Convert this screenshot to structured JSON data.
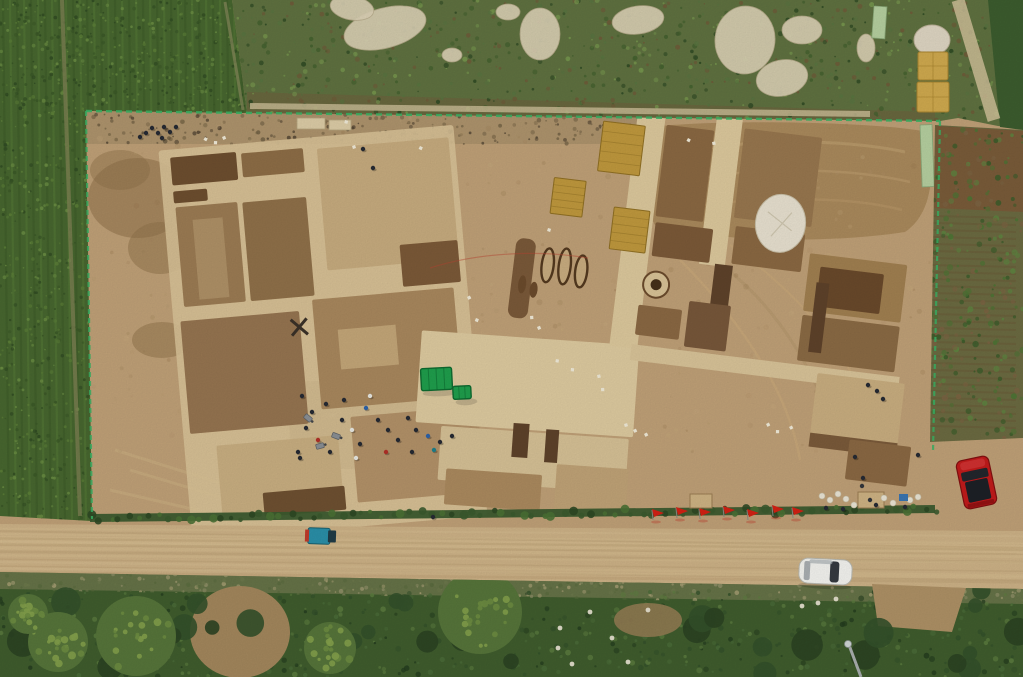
{
  "meta": {
    "type": "aerial-photograph",
    "description": "Aerial drone view of a large rectangular archaeological excavation compound cut into tan earth, surrounded by green corn fields and scrub. Gridded excavation trenches with light baulks fill the left half; the right half has corridors, yellow straw mats, dark grave pits, a round kiln feature and spoil heaps. A green canopy tent stands mid-site with a crew of workers nearby. A row of red flags lines the southern hedge beside a dirt road carrying a white car and a blue cargo trike, with a red car parked on dirt at the right and stacked hay bales at the top-right corner.",
    "width": 1023,
    "height": 677
  },
  "palette": {
    "base_dirt": "#bfa077",
    "dirt_light": "#d2b98d",
    "dirt_dark": "#a1835b",
    "baulk": "#d8c297",
    "platform": "#ddca9f",
    "cell_brown": "#9b7b53",
    "cell_dark": "#7b5938",
    "pit_deep": "#5e422a",
    "corn": "#47662f",
    "scrub": "#5f7140",
    "garden": "#6b6a41",
    "veg_dark": "#3f5c2d",
    "tree_dark": "#2b4222",
    "tree_yellow": "#83a04b",
    "road": "#ccb186",
    "hedge": "#3b5a2e",
    "fence_green": "#3bb264",
    "tent_green": "#1f9e4c",
    "straw": "#bf983d",
    "hay": "#cfa94e",
    "flag_red": "#d22114",
    "car_red": "#c11b1b",
    "car_white": "#f3f3ef",
    "trike_blue": "#2a8fa8",
    "debris": "#dbd1b5",
    "tarp_white": "#e7e0cf"
  },
  "scene": {
    "noise_seed": 7,
    "corn": {
      "row_step": 7,
      "row_colors": [
        "#3d5a29",
        "#567a38"
      ]
    },
    "speckle_layers": [
      {
        "clip": "compound-speckle",
        "area": [
          90,
          118,
          840,
          335
        ],
        "count": 350,
        "rmin": 1,
        "rmax": 3,
        "opacity": 0.28,
        "colors": [
          "#b2946b",
          "#a5855c",
          "#c9ad81",
          "#96784f"
        ]
      },
      {
        "clip": "topband-speckle",
        "area": [
          92,
          114,
          545,
          30
        ],
        "count": 200,
        "rmin": 0.8,
        "rmax": 2.4,
        "opacity": 0.8,
        "colors": [
          "#6b5b40",
          "#4e4130",
          "#7d6a4a"
        ]
      },
      {
        "clip": "scrub-speckle",
        "area": [
          235,
          0,
          788,
          122
        ],
        "count": 800,
        "rmin": 0.8,
        "rmax": 2.6,
        "opacity": 0.9,
        "colors": [
          "#43602e",
          "#77974e",
          "#6f5a38",
          "#2f4a24",
          "#587440"
        ]
      },
      {
        "clip": "corn-speckle-top",
        "area": [
          0,
          0,
          250,
          116
        ],
        "count": 520,
        "rmin": 0.7,
        "rmax": 2,
        "opacity": 0.85,
        "colors": [
          "#3a5727",
          "#5d8038",
          "#2f4a22",
          "#6c8f44"
        ]
      },
      {
        "clip": "corn-speckle-left",
        "area": [
          0,
          116,
          96,
          406
        ],
        "count": 460,
        "rmin": 0.7,
        "rmax": 2,
        "opacity": 0.85,
        "colors": [
          "#3a5727",
          "#5d8038",
          "#2f4a22",
          "#6c8f44"
        ]
      },
      {
        "clip": "garden-speckle",
        "area": [
          930,
          128,
          93,
          310
        ],
        "count": 260,
        "rmin": 1,
        "rmax": 3.2,
        "opacity": 0.9,
        "colors": [
          "#4c7434",
          "#5d8540",
          "#3a5c2a",
          "#7b6342"
        ]
      },
      {
        "clip": "verge-speckle",
        "area": [
          0,
          574,
          1023,
          28
        ],
        "count": 420,
        "rmin": 0.8,
        "rmax": 2.4,
        "opacity": 0.7,
        "colors": [
          "#9a9670",
          "#6f7a4d",
          "#57693c",
          "#b5a87e"
        ]
      },
      {
        "clip": "bottom-speckle",
        "area": [
          0,
          592,
          1023,
          85
        ],
        "count": 550,
        "rmin": 1,
        "rmax": 3,
        "opacity": 0.85,
        "colors": [
          "#33502a",
          "#4a6b38",
          "#5d7d40",
          "#243c1e"
        ]
      }
    ],
    "pale_debris": [
      {
        "x": 385,
        "y": 28,
        "rx": 42,
        "ry": 20,
        "rot": -15
      },
      {
        "x": 352,
        "y": 8,
        "rx": 22,
        "ry": 12,
        "rot": 10
      },
      {
        "x": 540,
        "y": 34,
        "rx": 20,
        "ry": 26,
        "rot": 0
      },
      {
        "x": 638,
        "y": 20,
        "rx": 26,
        "ry": 14,
        "rot": -8
      },
      {
        "x": 745,
        "y": 40,
        "rx": 30,
        "ry": 34,
        "rot": 6
      },
      {
        "x": 782,
        "y": 78,
        "rx": 26,
        "ry": 18,
        "rot": -12
      },
      {
        "x": 802,
        "y": 30,
        "rx": 20,
        "ry": 14,
        "rot": 0
      },
      {
        "x": 452,
        "y": 55,
        "rx": 10,
        "ry": 7,
        "rot": 0
      },
      {
        "x": 508,
        "y": 12,
        "rx": 12,
        "ry": 8,
        "rot": 0
      },
      {
        "x": 866,
        "y": 48,
        "rx": 9,
        "ry": 14,
        "rot": 0
      }
    ],
    "boards": [
      {
        "x": 874,
        "y": 6,
        "w": 13,
        "h": 32,
        "rot": 4
      },
      {
        "x": 920,
        "y": 125,
        "w": 12,
        "h": 62,
        "rot": -2
      }
    ],
    "hay": {
      "tarp": {
        "x": 932,
        "y": 40,
        "rx": 18,
        "ry": 15
      },
      "bales": [
        {
          "x": 918,
          "y": 52,
          "w": 30,
          "h": 28
        },
        {
          "x": 917,
          "y": 82,
          "w": 32,
          "h": 30
        }
      ]
    },
    "garden_rows": {
      "y0": 216,
      "y1": 430,
      "step": 7,
      "x0": 930,
      "x1": 1016
    },
    "hedge": {
      "x0": 90,
      "y0": 518,
      "x1": 935,
      "y1": 509,
      "count": 85,
      "colors": [
        "#2e4824",
        "#4a7034",
        "#3b5a2e"
      ]
    },
    "flags": {
      "xs": [
        652,
        676,
        699,
        723,
        747,
        772,
        792
      ],
      "ys": [
        516,
        514,
        515,
        513,
        516,
        512,
        514
      ]
    },
    "road_streaks": {
      "count": 14,
      "colors": [
        "#d8c194",
        "#b79b71"
      ]
    },
    "tents": [
      {
        "x": 421,
        "y": 368,
        "w": 31,
        "h": 22,
        "ribs": 3
      },
      {
        "x": 453,
        "y": 386,
        "w": 18,
        "h": 13,
        "ribs": 2
      }
    ],
    "mats": [
      {
        "x": 585,
        "y": 134,
        "w": 42,
        "h": 50
      },
      {
        "x": 606,
        "y": 218,
        "w": 36,
        "h": 42
      },
      {
        "x": 543,
        "y": 196,
        "w": 32,
        "h": 36
      }
    ],
    "grave_strip": {
      "x": 513,
      "y": 260,
      "w": 20,
      "h": 80
    },
    "graves": [
      {
        "x": 547,
        "y": 284,
        "rx": 6,
        "ry": 17
      },
      {
        "x": 564,
        "y": 283,
        "rx": 6,
        "ry": 18
      },
      {
        "x": 581,
        "y": 286,
        "rx": 6,
        "ry": 16
      }
    ],
    "grave_blobs": [
      {
        "x": 524,
        "y": 306,
        "rx": 4,
        "ry": 9
      },
      {
        "x": 536,
        "y": 310,
        "rx": 4,
        "ry": 8
      }
    ],
    "kiln": {
      "cx": 657,
      "cy": 290,
      "r": 13,
      "core": 5.5
    },
    "tarp_pile": {
      "x": 773,
      "y": 214,
      "rx": 25,
      "ry": 29
    },
    "people_colors": [
      "#262a33",
      "#e8e8e2",
      "#b03028",
      "#2d62a8",
      "#1f7f8a"
    ],
    "crew": [
      [
        302,
        396,
        0
      ],
      [
        312,
        412,
        0
      ],
      [
        306,
        428,
        0
      ],
      [
        318,
        440,
        2
      ],
      [
        330,
        452,
        0
      ],
      [
        298,
        452,
        0
      ],
      [
        342,
        420,
        0
      ],
      [
        352,
        430,
        1
      ],
      [
        360,
        444,
        0
      ],
      [
        344,
        400,
        0
      ],
      [
        366,
        408,
        3
      ],
      [
        378,
        420,
        0
      ],
      [
        370,
        396,
        1
      ],
      [
        388,
        430,
        0
      ],
      [
        398,
        440,
        0
      ],
      [
        386,
        452,
        2
      ],
      [
        408,
        418,
        0
      ],
      [
        300,
        458,
        0
      ],
      [
        326,
        404,
        0
      ],
      [
        416,
        430,
        0
      ],
      [
        428,
        436,
        3
      ],
      [
        440,
        442,
        0
      ],
      [
        452,
        436,
        0
      ],
      [
        434,
        450,
        4
      ],
      [
        412,
        452,
        0
      ],
      [
        356,
        458,
        1
      ]
    ],
    "north_group": [
      [
        152,
        128,
        0
      ],
      [
        158,
        133,
        0
      ],
      [
        164,
        127,
        0
      ],
      [
        170,
        132,
        0
      ],
      [
        176,
        127,
        0
      ],
      [
        162,
        138,
        0
      ],
      [
        146,
        133,
        0
      ],
      [
        140,
        137,
        0
      ]
    ],
    "supply_group": [
      [
        826,
        508,
        0
      ],
      [
        843,
        509,
        0
      ],
      [
        876,
        505,
        0
      ],
      [
        905,
        507,
        0
      ]
    ],
    "lone_figures": [
      [
        363,
        149,
        0
      ],
      [
        373,
        168,
        0
      ],
      [
        868,
        385,
        0
      ],
      [
        877,
        391,
        0
      ],
      [
        883,
        399,
        0
      ],
      [
        855,
        457,
        0
      ],
      [
        863,
        478,
        0
      ],
      [
        918,
        455,
        0
      ],
      [
        433,
        517,
        0
      ]
    ],
    "wheelbarrows": [
      {
        "x": 336,
        "y": 436,
        "rot": 20
      },
      {
        "x": 320,
        "y": 446,
        "rot": -15
      },
      {
        "x": 308,
        "y": 418,
        "rot": 40
      }
    ],
    "tags": [
      [
        530,
        316
      ],
      [
        537,
        327
      ],
      [
        556,
        359
      ],
      [
        571,
        368
      ],
      [
        597,
        375
      ],
      [
        601,
        388
      ],
      [
        476,
        318
      ],
      [
        467,
        297
      ],
      [
        624,
        424
      ],
      [
        633,
        430
      ],
      [
        644,
        434
      ],
      [
        766,
        424
      ],
      [
        776,
        430
      ],
      [
        789,
        427
      ],
      [
        205,
        137
      ],
      [
        214,
        141
      ],
      [
        222,
        137
      ],
      [
        345,
        120
      ],
      [
        352,
        146
      ],
      [
        420,
        146
      ],
      [
        548,
        228
      ],
      [
        688,
        138
      ],
      [
        712,
        142
      ]
    ],
    "supplies": {
      "sacks": [
        [
          822,
          496
        ],
        [
          830,
          500
        ],
        [
          838,
          494
        ],
        [
          846,
          499
        ],
        [
          854,
          505
        ],
        [
          884,
          498
        ],
        [
          893,
          503
        ],
        [
          910,
          500
        ],
        [
          918,
          497
        ]
      ],
      "boxes": [
        {
          "x": 858,
          "y": 492,
          "w": 26,
          "h": 16
        },
        {
          "x": 690,
          "y": 494,
          "w": 22,
          "h": 14
        }
      ],
      "blue_item": {
        "x": 899,
        "y": 494,
        "w": 9,
        "h": 7
      },
      "dark_dots": [
        [
          862,
          486
        ],
        [
          870,
          500
        ]
      ]
    },
    "stones": [
      [
        558,
        648
      ],
      [
        572,
        664
      ],
      [
        590,
        612
      ],
      [
        612,
        638
      ],
      [
        628,
        662
      ],
      [
        648,
        610
      ],
      [
        560,
        628
      ],
      [
        802,
        606
      ],
      [
        818,
        603
      ],
      [
        836,
        599
      ]
    ],
    "trees": {
      "canopies": [
        {
          "x": 58,
          "y": 642,
          "r": 30
        },
        {
          "x": 136,
          "y": 636,
          "r": 40
        },
        {
          "x": 480,
          "y": 612,
          "r": 42
        },
        {
          "x": 28,
          "y": 614,
          "r": 20
        },
        {
          "x": 330,
          "y": 648,
          "r": 26
        }
      ],
      "dark_areas": [
        {
          "area": [
            0,
            600,
            560,
            77
          ],
          "count": 16
        },
        {
          "area": [
            950,
            590,
            73,
            87
          ],
          "count": 6
        },
        {
          "area": [
            690,
            612,
            200,
            65
          ],
          "count": 8
        }
      ]
    },
    "lamp": {
      "x1": 849,
      "y1": 645,
      "x2": 861,
      "y2": 677,
      "head_r": 3.5
    },
    "vehicles": {
      "red_car": {
        "x": 960,
        "y": 458,
        "w": 33,
        "h": 49,
        "rot": -12
      },
      "white_car": {
        "x": 799,
        "y": 559,
        "w": 53,
        "h": 25,
        "rot": 3
      },
      "blue_trike": {
        "x": 308,
        "y": 528,
        "w": 22,
        "h": 16,
        "rot": 2
      }
    }
  }
}
